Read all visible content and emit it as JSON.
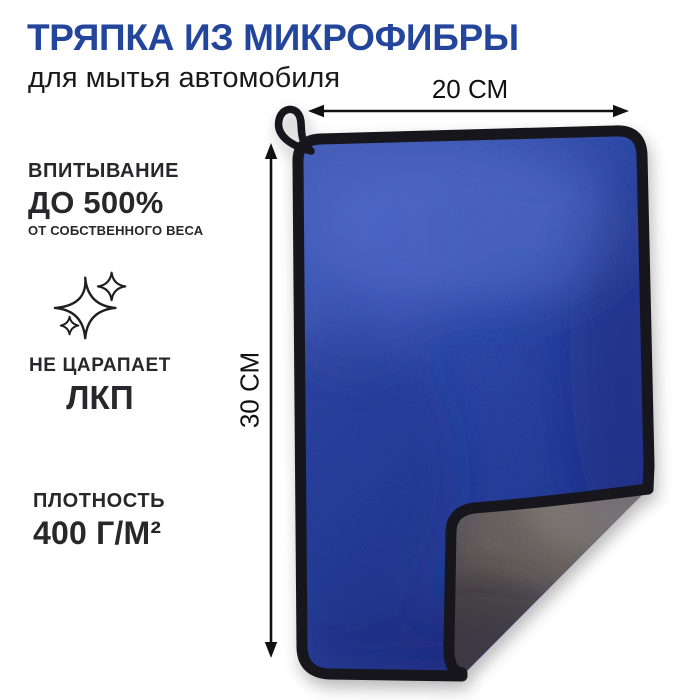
{
  "title": "ТРЯПКА ИЗ МИКРОФИБРЫ",
  "subtitle": "для мытья автомобиля",
  "features": [
    {
      "id": "absorption",
      "line1": "ВПИТЫВАНИЕ",
      "line2": "ДО 500%",
      "line3": "ОТ СОБСТВЕННОГО ВЕСА"
    },
    {
      "id": "no-scratch",
      "icon": "sparkles-icon",
      "line1": "НЕ ЦАРАПАЕТ",
      "line2": "ЛКП"
    },
    {
      "id": "density",
      "line1": "ПЛОТНОСТЬ",
      "line2": "400 Г/М²"
    }
  ],
  "dimensions": {
    "width": "20 СМ",
    "height": "30 СМ"
  },
  "product": {
    "item": "microfiber cloth for car washing, blue front, gray back, hanging loop",
    "front_color": "#2d49ac",
    "front_color_light": "#4662c0",
    "front_color_dark": "#1e348e",
    "back_color": "#6b6461",
    "back_color_light": "#7d7673",
    "back_color_dark": "#4e4947",
    "binding_color": "#17171b"
  },
  "colors": {
    "title_blue": "#24459c",
    "text_dark": "#28282c",
    "arrow_black": "#111111",
    "background": "#ffffff"
  }
}
